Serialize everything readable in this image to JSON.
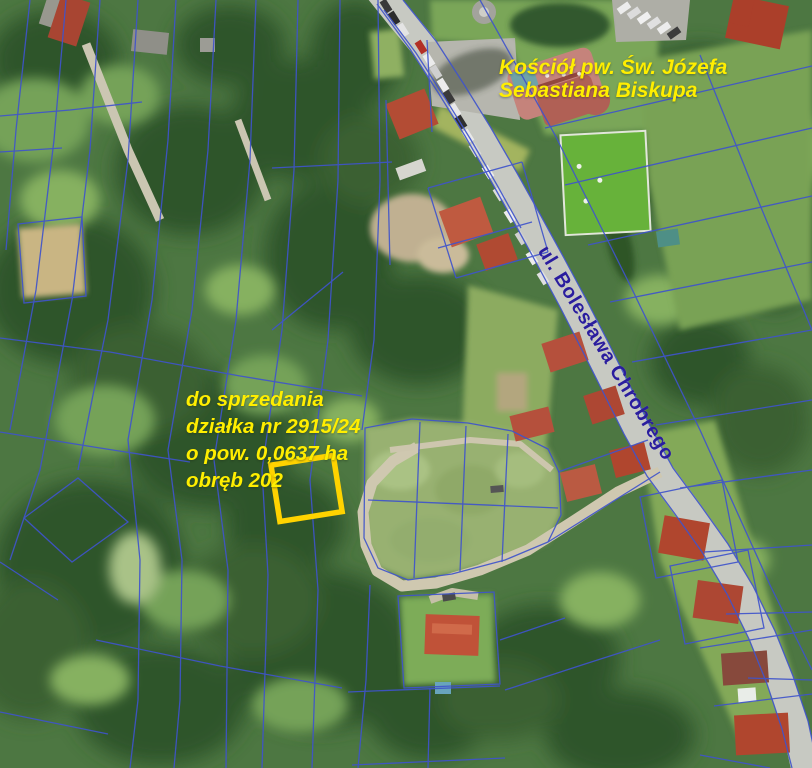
{
  "map": {
    "annotations": {
      "church_label": {
        "lines": [
          "Kościół pw. Św. Józefa",
          "Sebastiana Biskupa"
        ],
        "color": "#ffee00"
      },
      "sale_label": {
        "lines": [
          "do sprzedania",
          "działka nr 2915/24",
          "o pow. 0,0637 ha",
          "obręb 202"
        ],
        "color": "#ffee00"
      },
      "street_label": {
        "text": "ul. Bolesława Chrobrego",
        "color": "#2a1d9e"
      }
    },
    "parcel_highlight": {
      "parcel_number": "2915/24",
      "color": "#ffd300"
    },
    "cadastral_lines_color": "#3f54cb"
  }
}
